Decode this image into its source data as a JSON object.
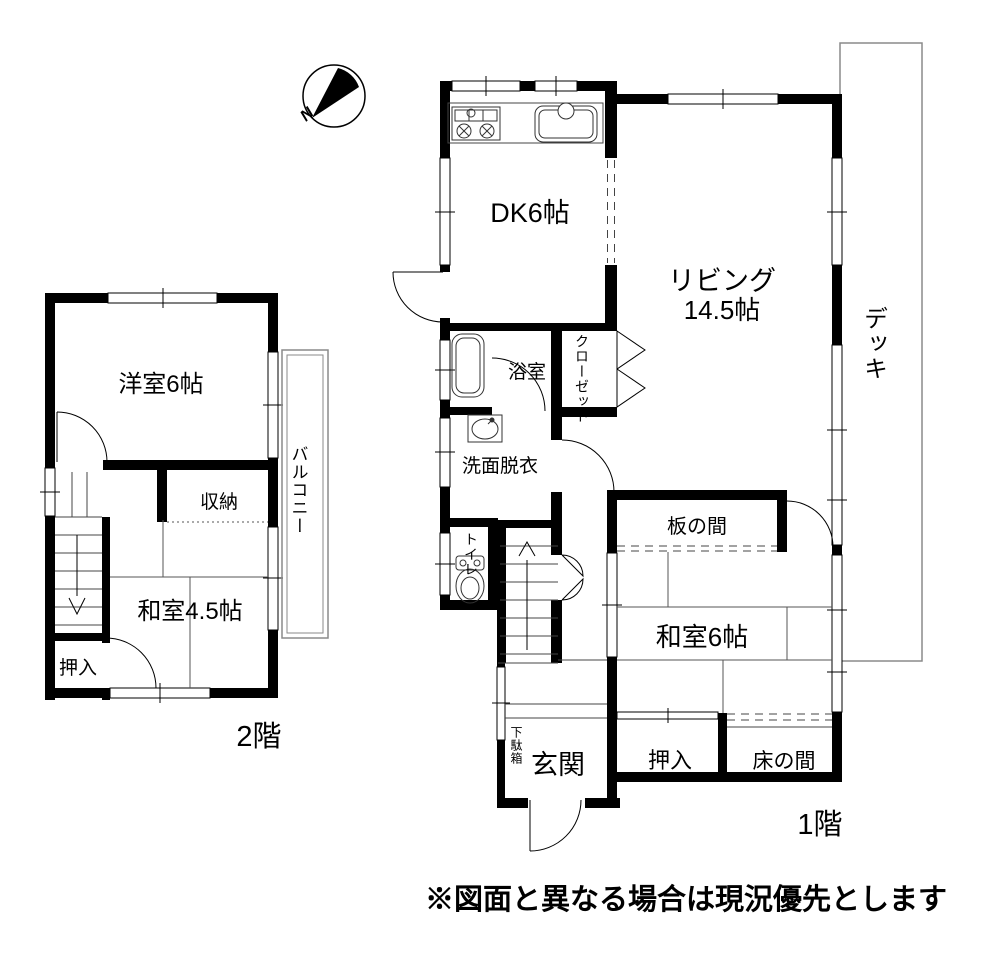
{
  "compass": {
    "north_label": "N"
  },
  "caption": "※図面と異なる場合は現況優先とします",
  "colors": {
    "wall": "#000000",
    "thin_line": "#444444",
    "outline_gray": "#8a8a8a",
    "background": "#ffffff"
  },
  "floor1": {
    "label": "1階",
    "rooms": {
      "dk": "DK6帖",
      "living_line1": "リビング",
      "living_line2": "14.5帖",
      "bath": "浴室",
      "closet": "クローゼット",
      "washroom": "洗面脱衣",
      "toilet": "トイレ",
      "itanoma": "板の間",
      "washitsu6": "和室6帖",
      "oshiire": "押入",
      "tokonoma": "床の間",
      "genkan": "玄関",
      "getabako": "下駄箱",
      "deck": "デッキ"
    }
  },
  "floor2": {
    "label": "2階",
    "rooms": {
      "youshitsu": "洋室6帖",
      "shuunou": "収納",
      "washitsu45": "和室4.5帖",
      "oshiire": "押入",
      "balcony": "バルコニー"
    }
  }
}
